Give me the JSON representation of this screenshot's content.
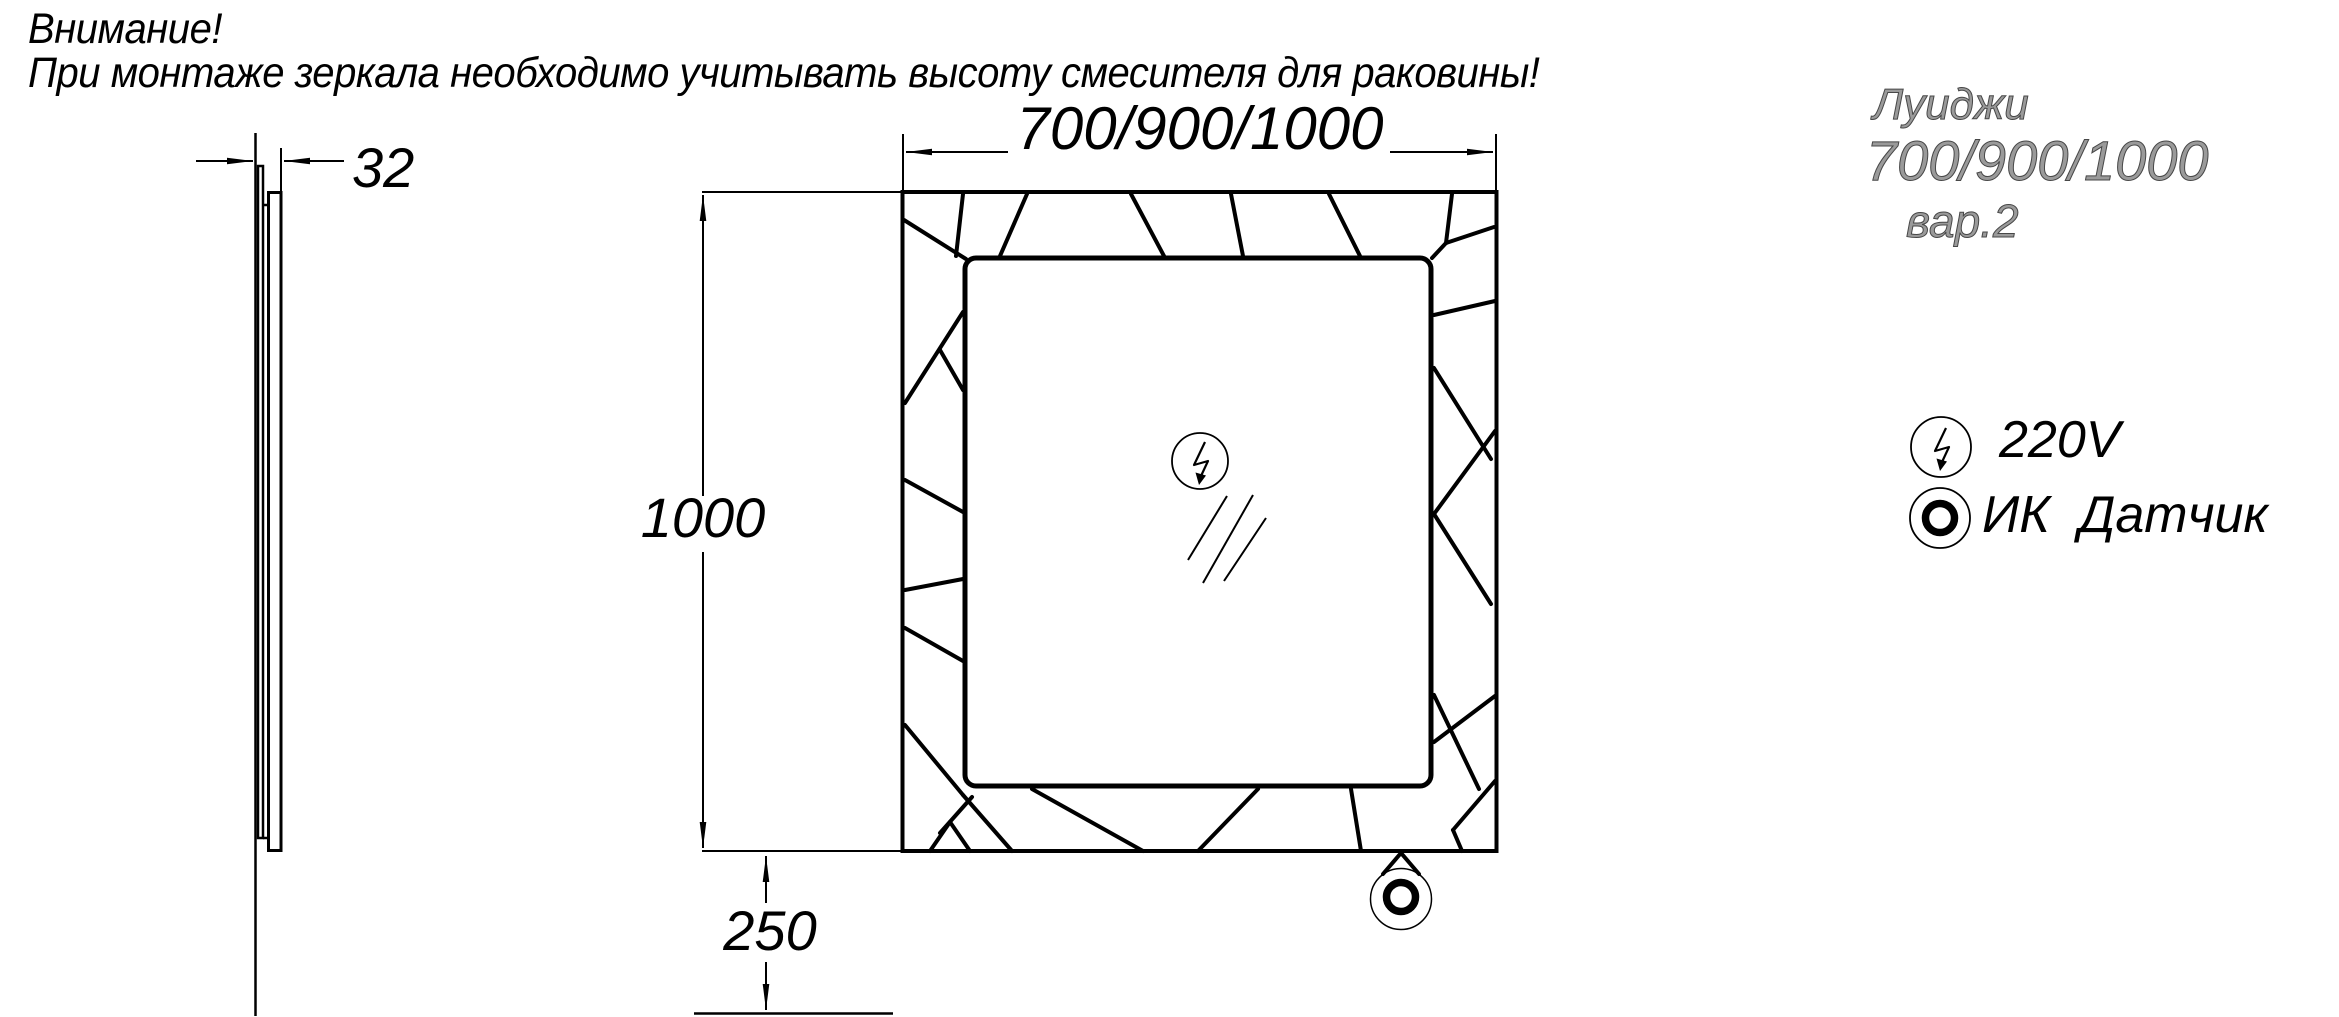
{
  "warning": {
    "line1": "Внимание!",
    "line2": "При монтаже зеркала необходимо учитывать высоту смесителя для раковины!"
  },
  "dimensions": {
    "depth": "32",
    "width": "700/900/1000",
    "height": "1000",
    "bottom_offset": "250"
  },
  "model_label": {
    "name": "Луиджи",
    "sizes": "700/900/1000",
    "variant": "вар.2"
  },
  "legend": {
    "power": {
      "icon": "lightning-circle-icon",
      "label": "220V"
    },
    "sensor": {
      "icon": "ir-sensor-icon",
      "label": "ИК  Датчик"
    }
  },
  "colors": {
    "drawing_line": "#000000",
    "background": "#ffffff",
    "model_label_outline": "#474747"
  }
}
